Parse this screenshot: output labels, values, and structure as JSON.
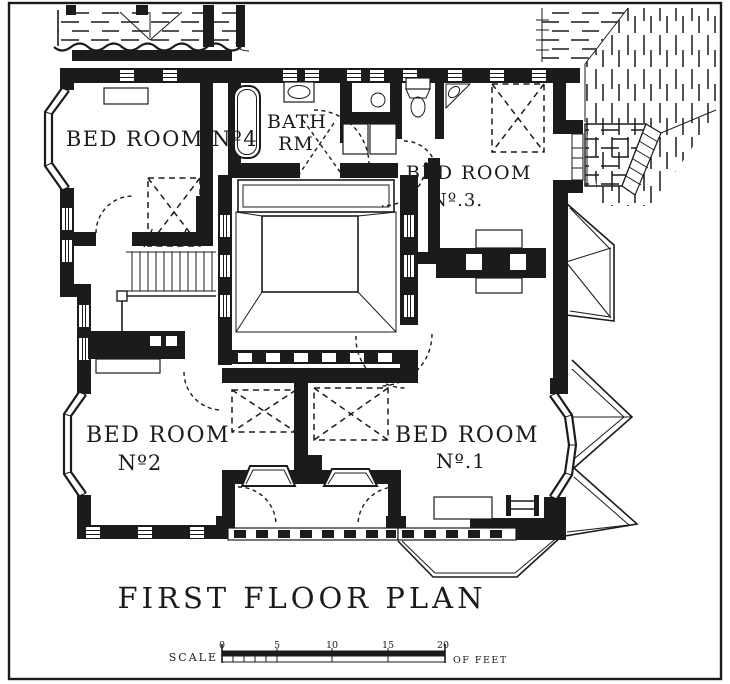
{
  "drawing": {
    "title": "FIRST FLOOR PLAN",
    "rooms": {
      "bedroom4": {
        "label": "BED ROOM Nº4"
      },
      "bathroom": {
        "line1": "BATH",
        "line2": "RM"
      },
      "bedroom3": {
        "line1": "BED ROOM",
        "line2": "Nº.3."
      },
      "bedroom2": {
        "line1": "BED ROOM",
        "line2": "Nº2"
      },
      "bedroom1": {
        "line1": "BED ROOM",
        "line2": "Nº.1"
      }
    },
    "scale_bar": {
      "label": "SCALE",
      "units": "OF FEET",
      "ticks": [
        "0",
        "5",
        "10",
        "15",
        "20"
      ]
    },
    "colors": {
      "ink": "#1b1b1b",
      "paper": "#ffffff"
    }
  }
}
